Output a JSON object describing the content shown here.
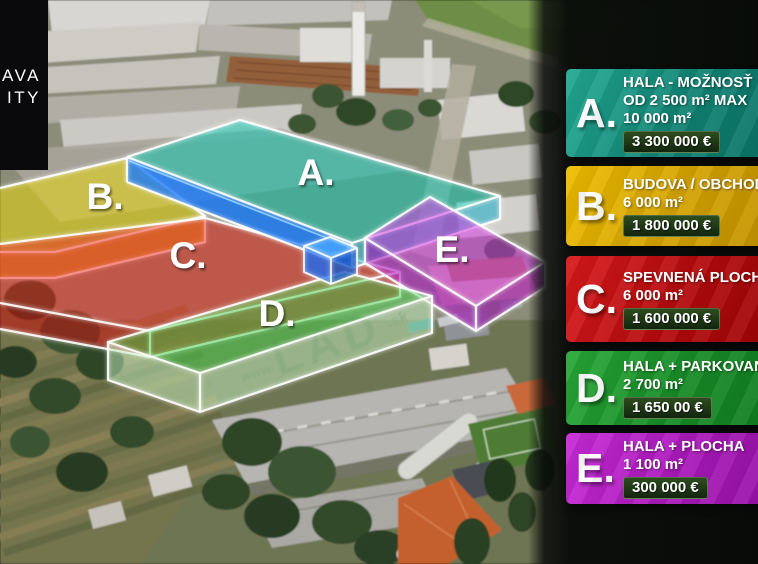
{
  "logo": {
    "line1": "AVA",
    "line2": "ITY"
  },
  "zones": [
    {
      "id": "A",
      "label": "A.",
      "top_fill": "#00cdb6",
      "front_fill": "#1578ff"
    },
    {
      "id": "B",
      "label": "B.",
      "top_fill": "#f0dc00",
      "front_fill": "#f0a800"
    },
    {
      "id": "C",
      "label": "C.",
      "top_fill": "#ef231c",
      "front_fill": "#c50d0d"
    },
    {
      "id": "D",
      "label": "D.",
      "top_fill": "#46d24c",
      "front_fill": "#c4efc0"
    },
    {
      "id": "E",
      "label": "E.",
      "top_fill": "#d23ae2",
      "front_fill": "#ae19c2"
    }
  ],
  "legend": {
    "price_badge_bg": "#1d3413",
    "cards": [
      {
        "letter": "A.",
        "color_from": "#23a993",
        "color_to": "#0a7164",
        "title_lines": [
          "HALA - MOŽNOSŤ",
          "OD 2 500 m² MAX"
        ],
        "area": "10 000 m²",
        "price": "3 300 000 €"
      },
      {
        "letter": "B.",
        "color_from": "#eebd00",
        "color_to": "#c19000",
        "title_lines": [
          "BUDOVA / OBCHOD"
        ],
        "area": "6 000 m²",
        "price": "1 800 000 €"
      },
      {
        "letter": "C.",
        "color_from": "#d8191b",
        "color_to": "#9c0305",
        "title_lines": [
          "SPEVNENÁ PLOCHA"
        ],
        "area": "6 000 m²",
        "price": "1 600 000 €"
      },
      {
        "letter": "D.",
        "color_from": "#28a837",
        "color_to": "#0f7d1e",
        "title_lines": [
          "HALA + PARKOVANIE"
        ],
        "area": "2 700 m²",
        "price": "1 650 00 €"
      },
      {
        "letter": "E.",
        "color_from": "#c82ad8",
        "color_to": "#9410a6",
        "title_lines": [
          "HALA + PLOCHA"
        ],
        "area": "1 100 m²",
        "price": "300 000 €"
      }
    ]
  },
  "roof_watermark": {
    "www": "www.",
    "main": "LAD",
    "tld": ".sk"
  }
}
